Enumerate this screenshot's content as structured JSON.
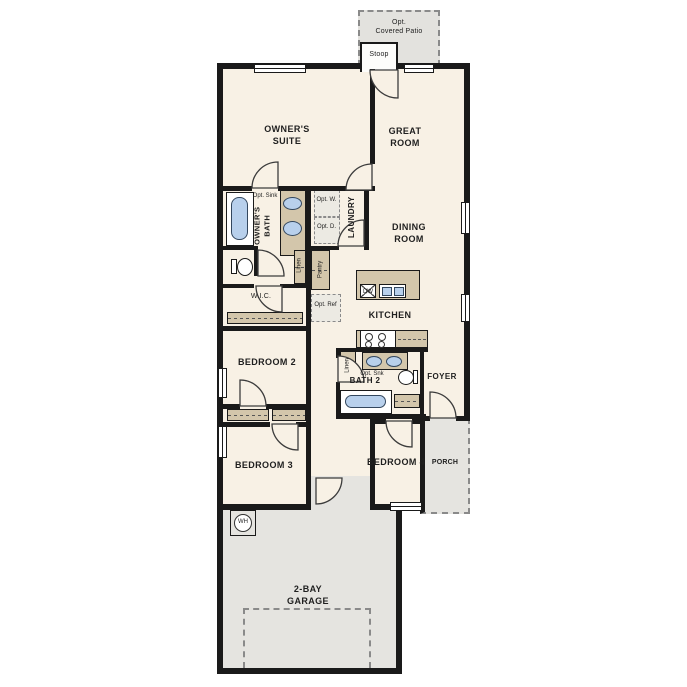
{
  "plan": {
    "title": "single-story floor plan",
    "rooms": {
      "patio_line1": "Opt.",
      "patio_line2": "Covered Patio",
      "stoop": "Stoop",
      "owners_suite": "OWNER'S SUITE",
      "great_room": "GREAT ROOM",
      "dining_room": "DINING ROOM",
      "kitchen": "KITCHEN",
      "owners_bath": "OWNER'S BATH",
      "laundry": "LAUNDRY",
      "wic": "W.I.C.",
      "bedroom2": "BEDROOM 2",
      "bedroom3": "BEDROOM 3",
      "bedroom4": "BEDROOM 4",
      "bath2": "BATH 2",
      "foyer": "FOYER",
      "porch": "PORCH",
      "garage": "2-BAY GARAGE"
    },
    "fixtures": {
      "opt_washer": "Opt. W.",
      "opt_dryer": "Opt. D.",
      "opt_ref": "Opt. Ref",
      "opt_sink_owners": "Opt. Sink",
      "opt_sink_bath2": "Opt. Snk",
      "linen_hall": "Linen",
      "linen_kitchen": "Linen",
      "pantry": "Pantry",
      "dishwasher": "DW",
      "water_heater": "WH"
    },
    "colors": {
      "wall": "#1a1a1a",
      "floor": "#f8f1e5",
      "concrete": "#e5e4e0",
      "casework": "#d3c6ab",
      "fixture_water": "#b8d0ec"
    }
  }
}
